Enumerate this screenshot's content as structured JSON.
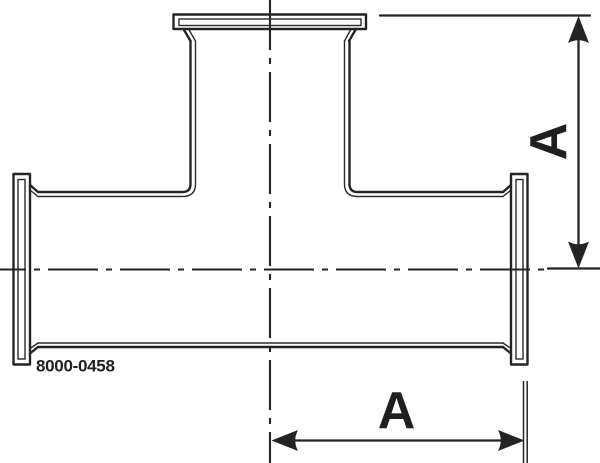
{
  "drawing": {
    "part_number": "8000-0458",
    "vertical_dimension": {
      "label": "A"
    },
    "horizontal_dimension": {
      "label": "A"
    }
  },
  "colors": {
    "line_color": "#242424",
    "background": "#ffffff"
  }
}
